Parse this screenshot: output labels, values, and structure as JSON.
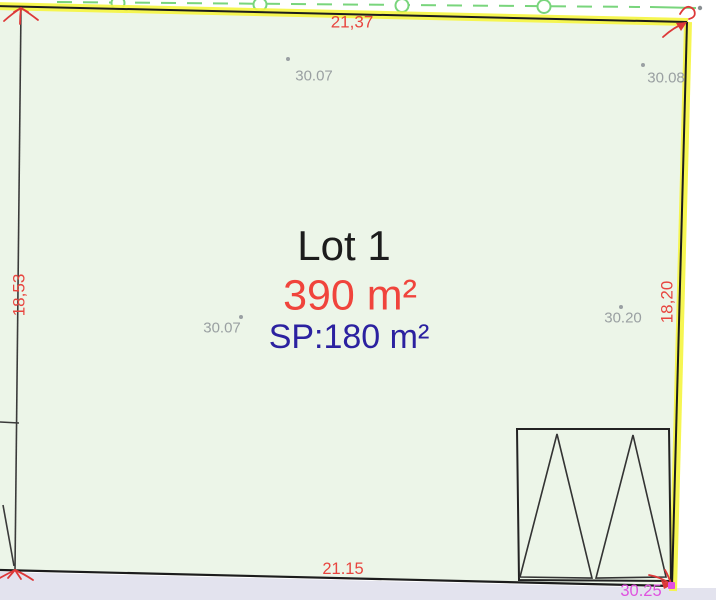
{
  "plan": {
    "title": "Lot 1",
    "area": "390 m²",
    "surface_plancher": "SP:180 m²",
    "dimensions": {
      "top": "21,37",
      "left": "18,53",
      "right": "18,20",
      "bottom": "21.15",
      "corner_right": "30.25"
    },
    "spot_elevations": [
      {
        "value": "30.07"
      },
      {
        "value": "30.08"
      },
      {
        "value": "30.07"
      },
      {
        "value": "30.20"
      }
    ],
    "colors": {
      "lot_fill": "#ecf5e8",
      "road_fill": "#e3e3ee",
      "boundary_highlight": "#f6f640",
      "boundary_line": "#1c1c1c",
      "dimension_text": "#e8453f",
      "area_text": "#f0443c",
      "sp_text": "#2b21a0",
      "corner_text": "#df52df",
      "elevation_text": "#9aa0a2",
      "utility_line": "#79d57c",
      "marker_red": "#dd3838",
      "marker_magenta": "#e24fe2"
    }
  }
}
